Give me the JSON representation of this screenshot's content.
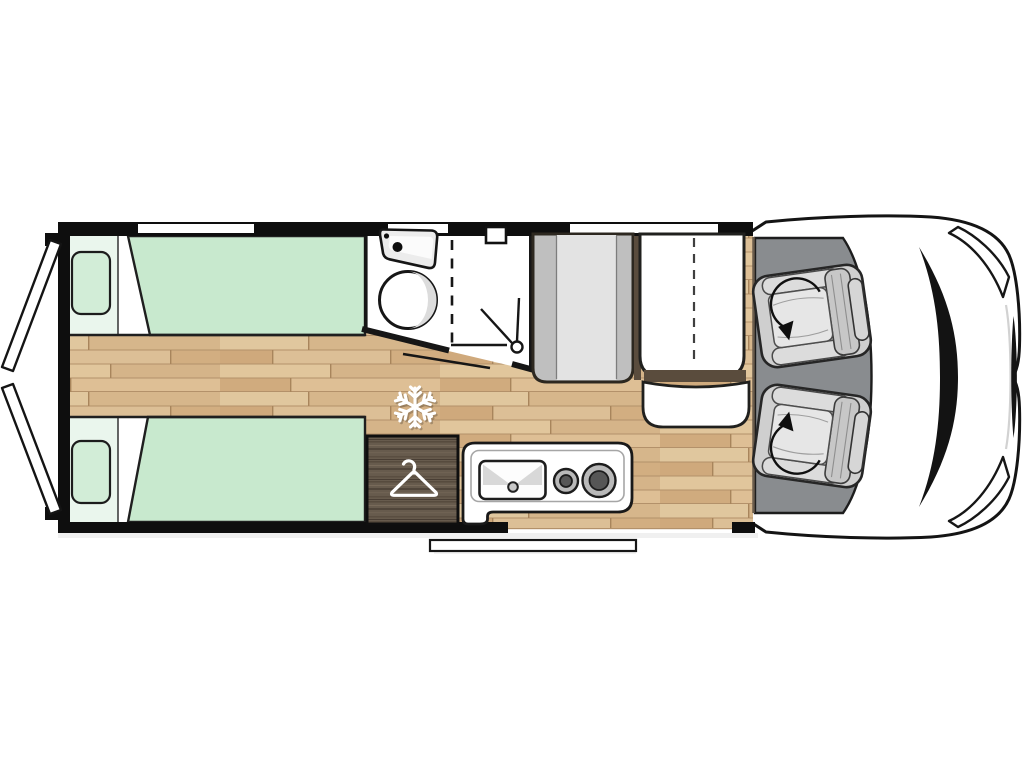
{
  "meta": {
    "description": "Top-down floor plan of a campervan / motorhome with rear twin beds, central washroom, wardrobe, kitchen, half-dinette and swivel cab seats",
    "orientation": "cab on right, rear doors on left"
  },
  "colors": {
    "background": "#ffffff",
    "wall": "#0e0e0e",
    "window_white": "#ffffff",
    "door_white": "#ffffff",
    "wood_base": "#d9bb91",
    "wood_accent_brown": "#5a4c3d",
    "bed_green": "#c8e9ce",
    "pillow_green": "#d2edd7",
    "headboard_pale": "#eaf6ed",
    "bathroom_white": "#ffffff",
    "fixture_gray": "#ececec",
    "wardrobe_wood": "#675b4d",
    "kitchen_white": "#ffffff",
    "burner_ring": "#b9b9b9",
    "burner_center": "#565656",
    "bench_gray": "#bfbfbf",
    "bench_gray_light": "#e3e3e3",
    "table_white": "#ffffff",
    "cab_floor": "#898c8f",
    "seat_shell": "#cfcfcf",
    "seat_band": "#dcdcdc",
    "seat_back": "#c7c7c7",
    "seat_headrest": "#d6d6d6",
    "seat_cushion": "#e6e6e6",
    "body_white": "#ffffff",
    "cowl_black": "#131313",
    "step_white": "#ffffff",
    "icon_white": "#ffffff"
  },
  "features": {
    "rear_doors": {
      "label": "Open rear doors",
      "count": 2
    },
    "bed_top": {
      "label": "Single bed (rear, upper)"
    },
    "bed_bottom": {
      "label": "Single bed (rear, lower)"
    },
    "pillows": {
      "label": "Pillows",
      "count": 2
    },
    "bathroom": {
      "label": "Washroom with basin, bowl and shower"
    },
    "washbasin": {
      "label": "Washbasin"
    },
    "shower": {
      "label": "Shower head"
    },
    "bathroom_door": {
      "label": "Sliding bathroom door"
    },
    "roof_vent": {
      "label": "Bathroom vent"
    },
    "fridge": {
      "label": "Refrigerator position",
      "icon": "snowflake-icon"
    },
    "wardrobe": {
      "label": "Wardrobe",
      "icon": "hanger-icon"
    },
    "kitchen": {
      "label": "Kitchen unit with sink and 2-burner hob"
    },
    "dinette_bench": {
      "label": "Dinette bench seat"
    },
    "dinette_table": {
      "label": "Folding table with extension"
    },
    "dinette_seat": {
      "label": "Dinette side seat"
    },
    "cab_seats": {
      "label": "Swivel cab seats",
      "count": 2,
      "icon": "rotation-arrow-icon"
    },
    "entry_door": {
      "label": "Entry doorway"
    },
    "entry_step": {
      "label": "Entry step"
    },
    "windows": {
      "label": "Windows",
      "count": 3
    }
  }
}
